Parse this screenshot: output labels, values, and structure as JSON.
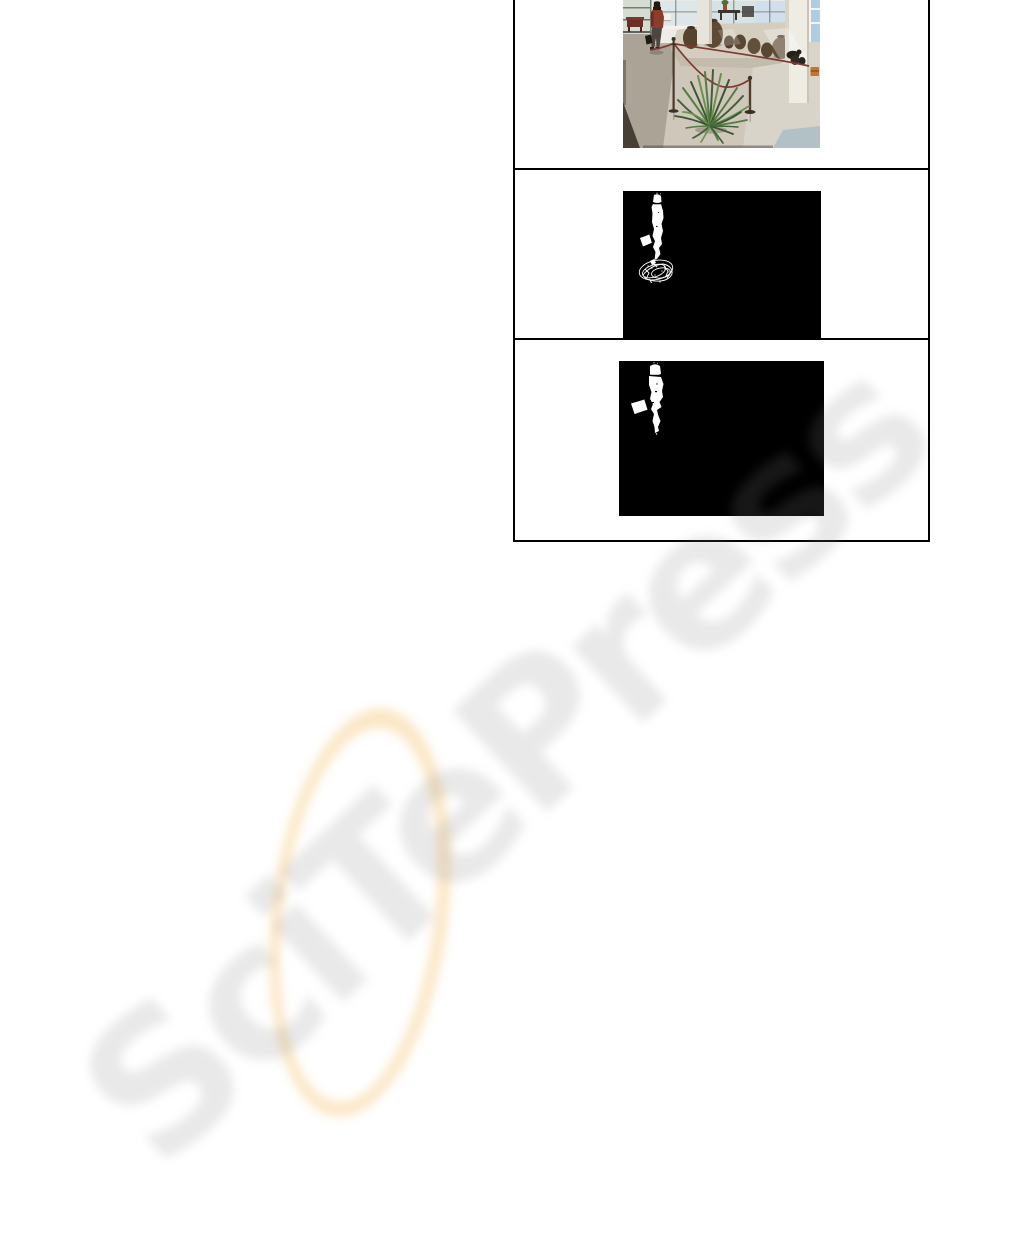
{
  "page": {
    "type": "paper-page-fragment",
    "background_color": "#ffffff"
  },
  "watermark": {
    "text": "SciTePress",
    "letter_color": "#eaeaea",
    "ring_color": "#f9e6c0",
    "rotation_deg": -43
  },
  "figure": {
    "border_color": "#000000",
    "panels": [
      {
        "id": "original-frame",
        "content": "surveillance camera frame: museum lobby with walking person, roped-off platform with urns, potted plant on marble floor"
      },
      {
        "id": "foreground-mask-with-shadow",
        "content": "binary foreground mask: white person silhouette with noisy white shadow blob",
        "background": "#000000",
        "foreground": "#ffffff"
      },
      {
        "id": "foreground-mask-shadow-removed",
        "content": "binary foreground mask: clean white person silhouette, shadow removed",
        "background": "#000000",
        "foreground": "#ffffff"
      }
    ]
  }
}
